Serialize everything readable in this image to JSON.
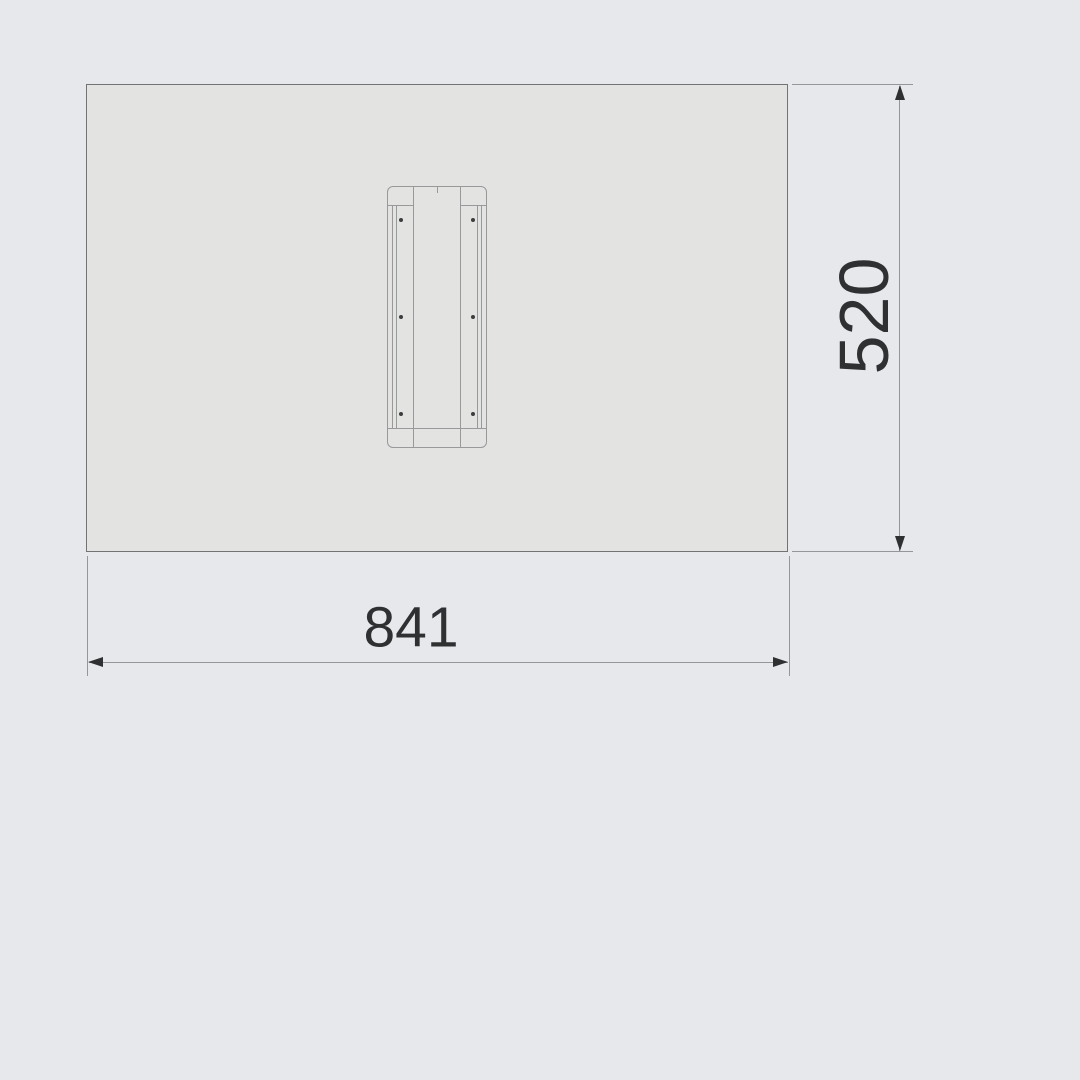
{
  "colors": {
    "bg": "#e6e8eb",
    "panel-fill": "#e3e3e2",
    "panel-border": "#717375",
    "bracket-stroke": "#97999b",
    "dot": "#3b3d3f",
    "line": "#94979a",
    "ink": "#2e3032"
  },
  "dimensions": {
    "width": {
      "label": "841"
    },
    "height": {
      "label": "520"
    }
  }
}
